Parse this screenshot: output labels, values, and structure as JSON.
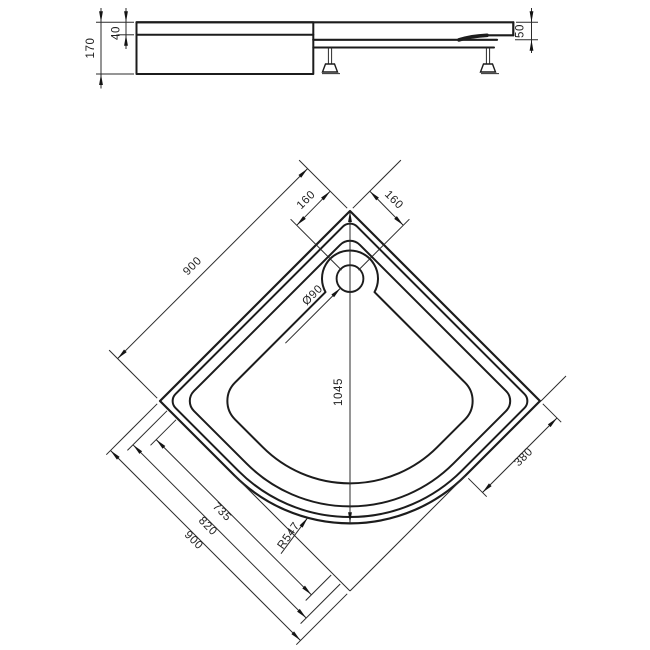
{
  "side_view": {
    "height_label": "170",
    "rim_label": "40",
    "edge_label": "50"
  },
  "plan_view": {
    "offset_left": "160",
    "offset_right": "160",
    "side_left": "900",
    "drain_label": "Ø90",
    "center_label": "1045",
    "edge_right": "380",
    "inner_width": "735",
    "mid_width": "820",
    "outer_width": "900",
    "radius_label": "R547"
  }
}
